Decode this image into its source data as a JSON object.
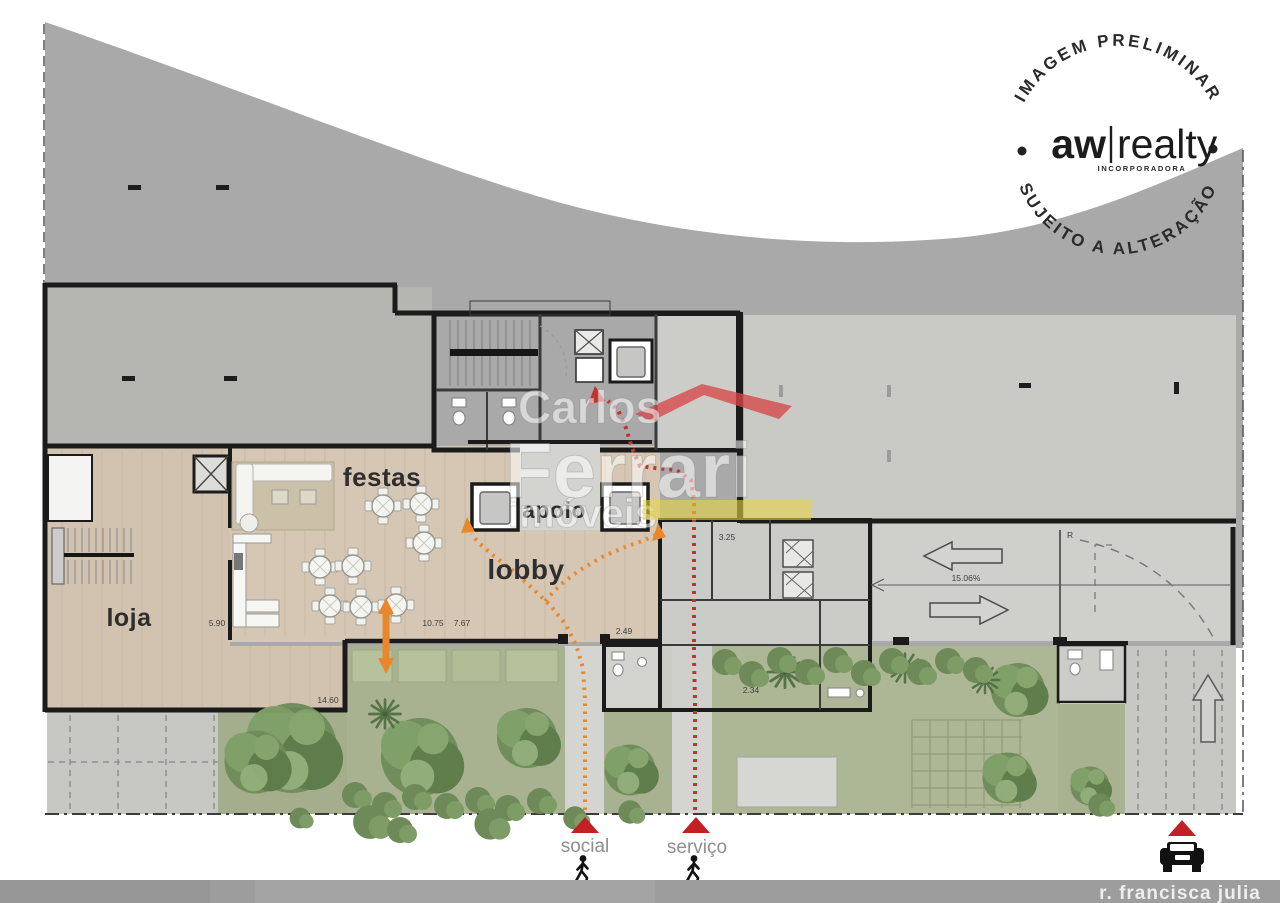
{
  "stamp": {
    "arc_top": "IMAGEM PRELIMINAR",
    "arc_bottom": "SUJEITO A ALTERAÇÃO",
    "brand_left": "aw",
    "brand_right": "realty",
    "brand_sub": "INCORPORADORA"
  },
  "watermark": {
    "line1": "Carlos",
    "line2": "Ferrari",
    "line3": "imóveis"
  },
  "rooms": {
    "loja": "loja",
    "festas": "festas",
    "apoio": "apoio",
    "lobby": "lobby"
  },
  "entrances": {
    "social": "social",
    "servico": "serviço",
    "street": "r. francisca julia"
  },
  "dimensions": {
    "ramp_slope": "15.06%",
    "festas_width": "5.90",
    "lobby_w1": "10.75",
    "lobby_w2": "7.67",
    "garden_width": "14.60",
    "wc_width": "2.49",
    "room_w": "3.25",
    "room_d": "2.34",
    "r_mark": "R"
  },
  "colors": {
    "site_gray": "#a9a9a9",
    "building_gray": "#c9c9c6",
    "wood": "#d5c7b4",
    "garden_green": "#a8b290",
    "street_gray": "#9d9d9d",
    "entrance_red": "#c32026",
    "path_orange": "#e8872c",
    "path_red": "#bf3330",
    "watermark_red": "#d64848",
    "watermark_yellow": "#e8d546"
  }
}
